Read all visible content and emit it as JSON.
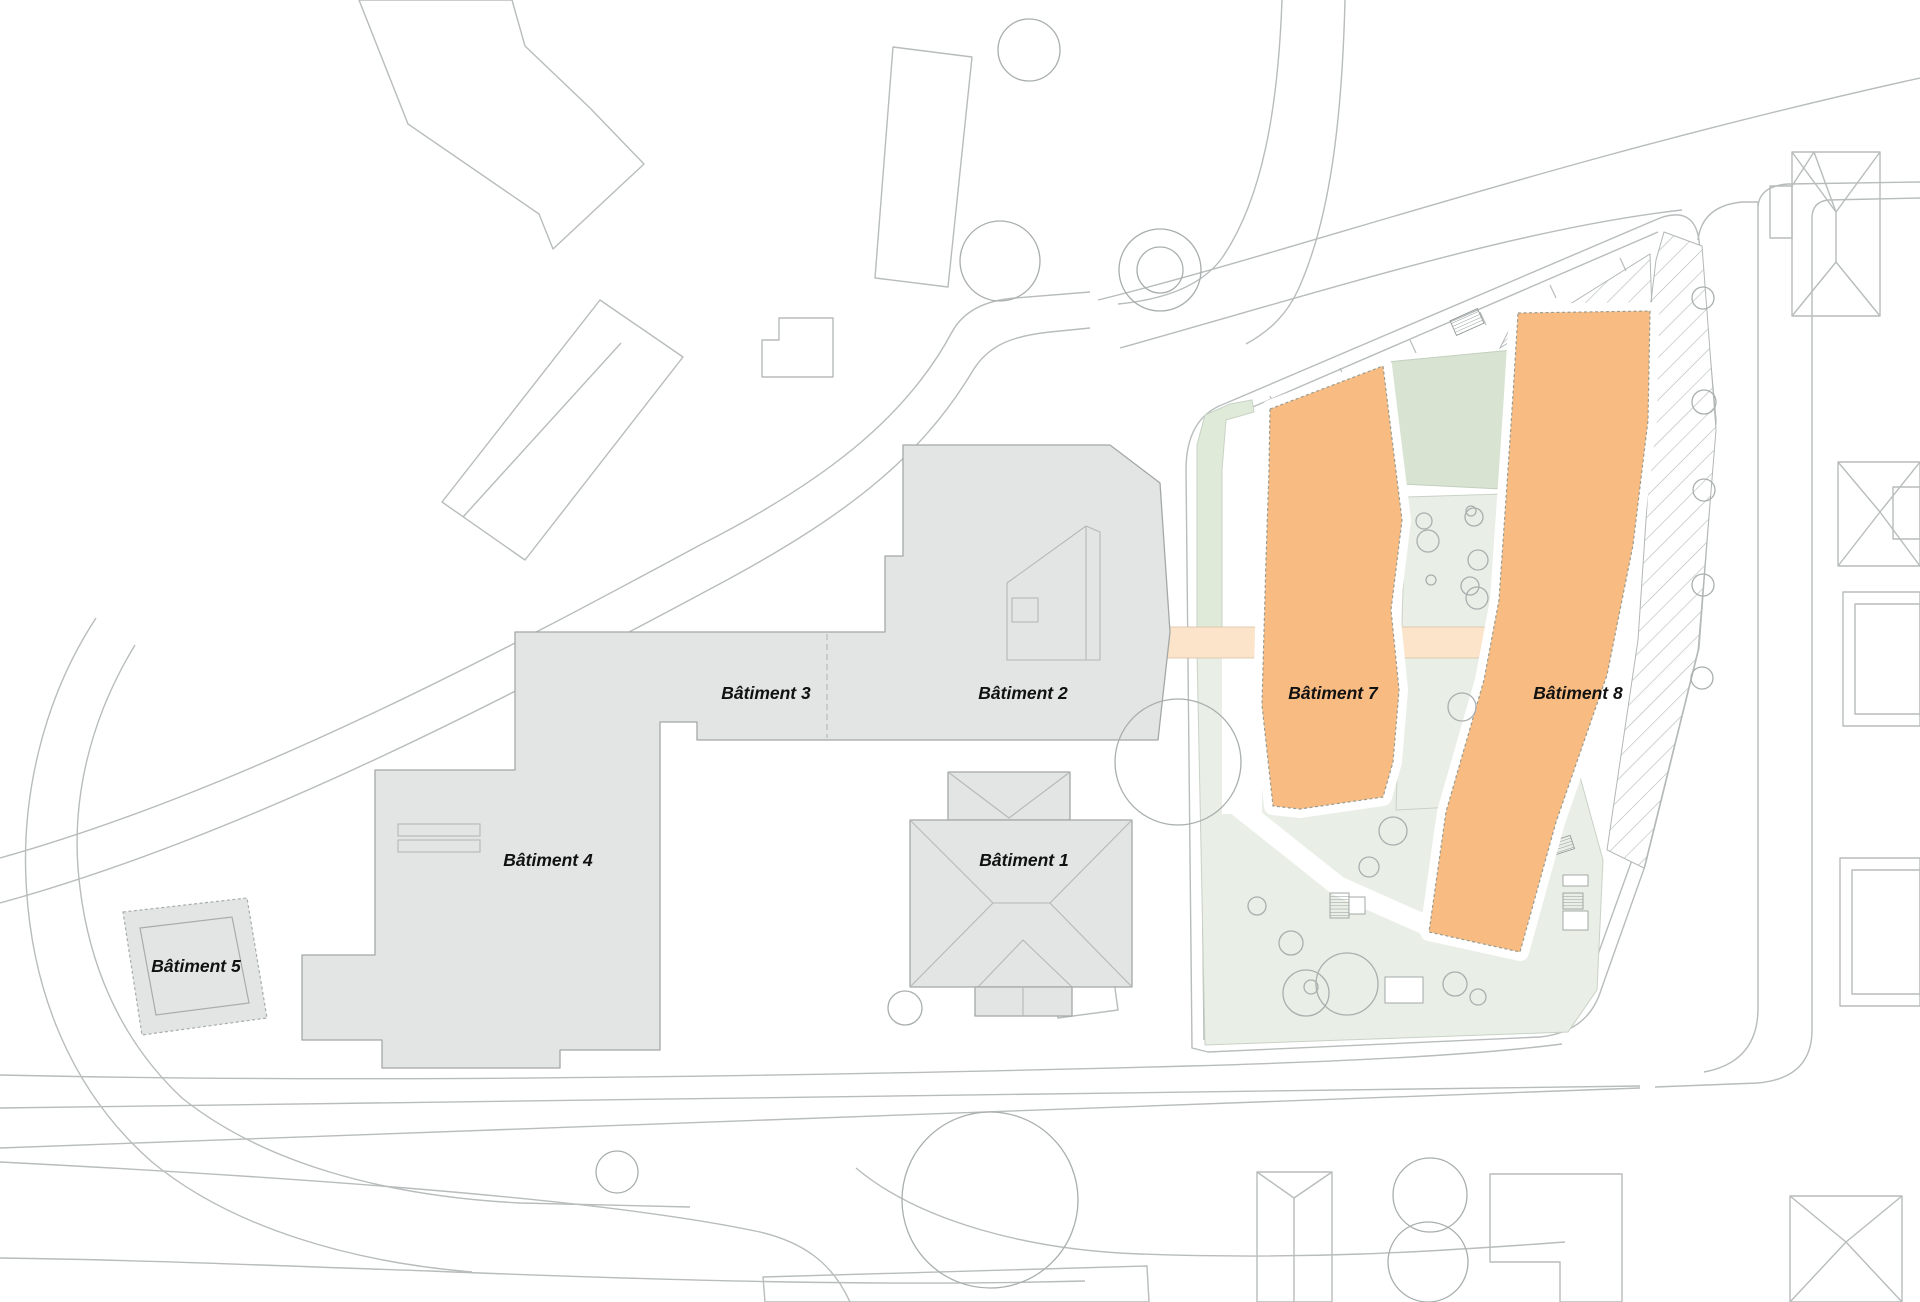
{
  "plan": {
    "type": "architectural-site-plan",
    "highlight_meaning": "new buildings highlighted in orange"
  },
  "buildings": [
    {
      "id": "batiment-1",
      "label": "Bâtiment 1",
      "highlighted": false
    },
    {
      "id": "batiment-2",
      "label": "Bâtiment 2",
      "highlighted": false
    },
    {
      "id": "batiment-3",
      "label": "Bâtiment 3",
      "highlighted": false
    },
    {
      "id": "batiment-4",
      "label": "Bâtiment 4",
      "highlighted": false
    },
    {
      "id": "batiment-5",
      "label": "Bâtiment 5",
      "highlighted": false
    },
    {
      "id": "batiment-7",
      "label": "Bâtiment 7",
      "highlighted": true
    },
    {
      "id": "batiment-8",
      "label": "Bâtiment 8",
      "highlighted": true
    }
  ],
  "colors": {
    "highlight_orange": "#f8bc83",
    "gray_building": "#e3e5e4",
    "light_green": "#e9efe6",
    "mid_green": "#e0ead9",
    "dark_green": "#d8e4d1",
    "bridge_peach": "#fbe4ca",
    "line_gray": "#b8bcbc",
    "outline_dark": "#a3a8a6",
    "detail_gray": "#b4b8b6",
    "tree_gray": "#a9aeae",
    "label_color": "#111111",
    "paper": "#ffffff"
  }
}
